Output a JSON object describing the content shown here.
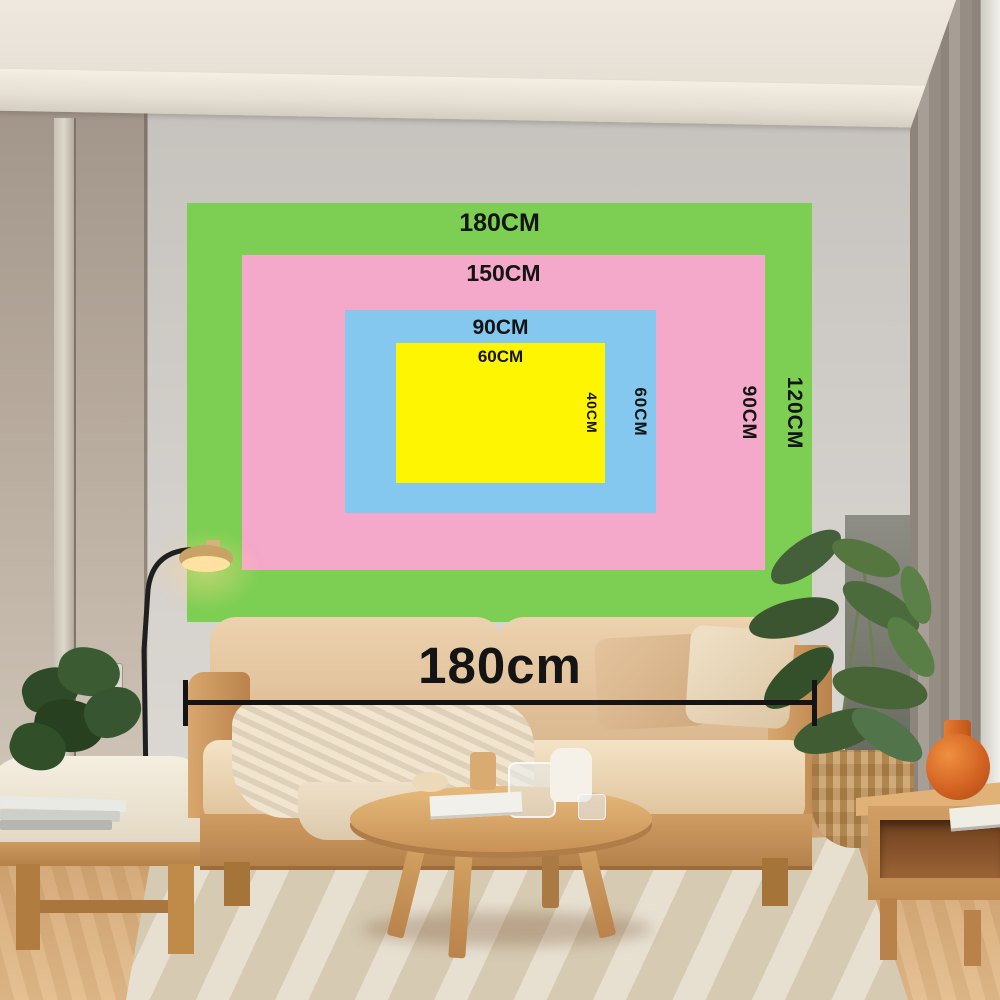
{
  "size_chart": {
    "text_color": "#141414",
    "layers": [
      {
        "id": "green",
        "color": "#7ccf52",
        "width_label": "180CM",
        "height_label": "120CM"
      },
      {
        "id": "pink",
        "color": "#f4a8ca",
        "width_label": "150CM",
        "height_label": "90CM"
      },
      {
        "id": "blue",
        "color": "#84c8f0",
        "width_label": "90CM",
        "height_label": "60CM"
      },
      {
        "id": "yellow",
        "color": "#fdf501",
        "width_label": "60CM",
        "height_label": "40CM"
      }
    ]
  },
  "measurement": {
    "label": "180cm",
    "color": "#141414"
  }
}
